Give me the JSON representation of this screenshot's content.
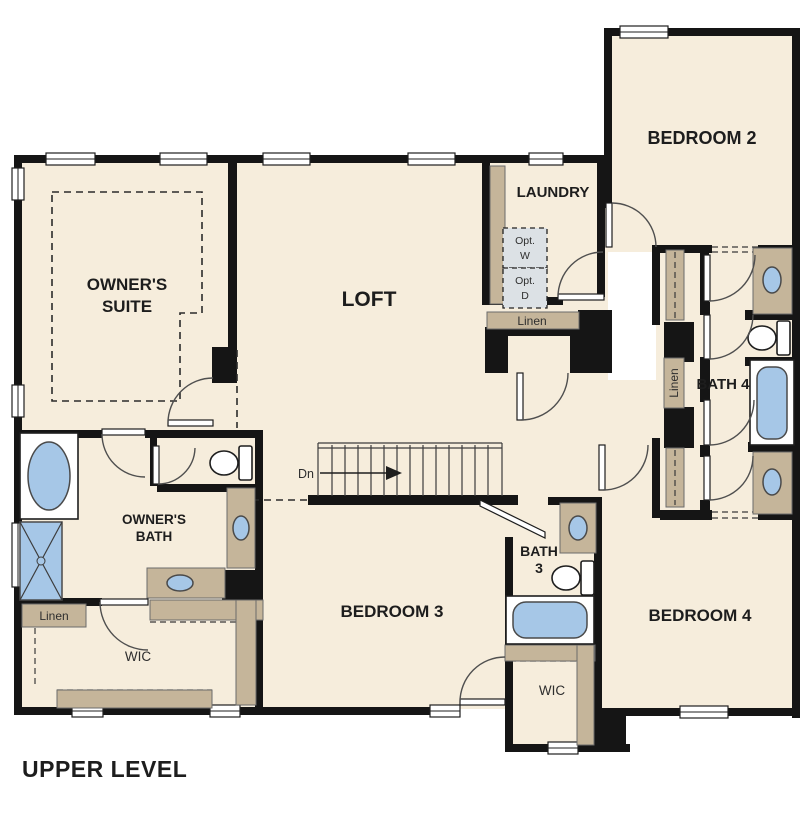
{
  "title": "UPPER LEVEL",
  "colors": {
    "wall": "#151515",
    "room": "#f6eddc",
    "counter": "#c5b59a",
    "fixture_blue": "#a6c7e7",
    "opt_fill": "#dce1e5",
    "label": "#1c1c1c"
  },
  "labels": {
    "owners_suite_1": "OWNER'S",
    "owners_suite_2": "SUITE",
    "loft": "LOFT",
    "laundry": "LAUNDRY",
    "bedroom2": "BEDROOM 2",
    "bedroom3": "BEDROOM 3",
    "bedroom4": "BEDROOM 4",
    "owners_bath_1": "OWNER'S",
    "owners_bath_2": "BATH",
    "bath3_1": "BATH",
    "bath3_2": "3",
    "bath4": "BATH 4",
    "wic_owners": "WIC",
    "wic_bedroom3": "WIC",
    "linen_laundry": "Linen",
    "linen_owners": "Linen",
    "linen_hall": "Linen",
    "opt_washer_1": "Opt.",
    "opt_washer_2": "W",
    "opt_dryer_1": "Opt.",
    "opt_dryer_2": "D",
    "stairs_down": "Dn"
  }
}
